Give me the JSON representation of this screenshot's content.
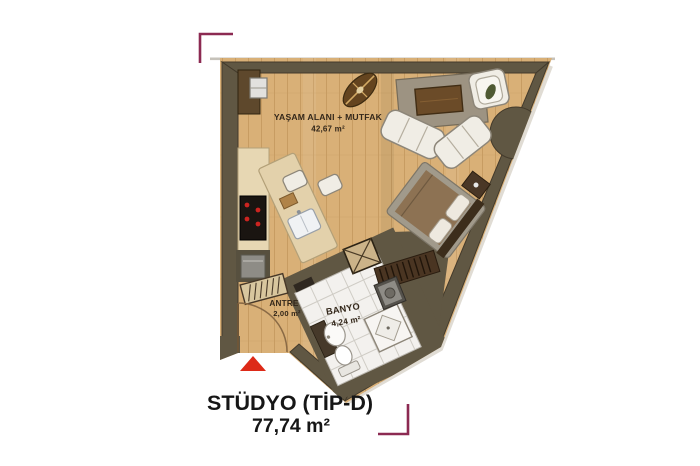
{
  "plan": {
    "title": "STÜDYO (TİP-D)",
    "total_area": "77,74 m²",
    "rooms": {
      "living": {
        "name": "YAŞAM ALANI + MUTFAK",
        "area": "42,67 m²"
      },
      "entry": {
        "name": "ANTRE",
        "area": "2,00 m²"
      },
      "bath": {
        "name": "BANYO",
        "area": "4,24 m²"
      }
    }
  },
  "colors": {
    "wall": "#605743",
    "wall_edge": "#433a2b",
    "floor": "#d9b077",
    "floor_line": "#c5995e",
    "tile": "#f3f1ee",
    "tile_line": "#cfccc5",
    "counter": "#e7d7b3",
    "counter_edge": "#b3a078",
    "island": "#e3d1ab",
    "rug": "#9d9382",
    "rug_edge": "#756b59",
    "wood_dark": "#5e482c",
    "white_furniture": "#f0ede5",
    "furniture_edge": "#8d8679",
    "bed_blanket": "#a19a8b",
    "bed_spread": "#8d7253",
    "headboard": "#3c2d1b",
    "appliance_gray": "#8e8c86",
    "cooktop_black": "#1a1511",
    "burner_red": "#cc2420",
    "marker": "#8c2a52",
    "entrance_arrow": "#dd2a18",
    "label_text": "#33271a",
    "title_text": "#161616",
    "outline_gray": "#c6c2ba"
  },
  "furniture": [
    "ceiling-fan",
    "area-rug",
    "coffee-table",
    "sofa",
    "armchair",
    "plant-leaf",
    "bed",
    "nightstand",
    "radiator-bench",
    "utility-shaft",
    "washing-machine",
    "shower",
    "washbasin",
    "toilet",
    "kitchen-island",
    "island-sink",
    "cutting-board",
    "bar-stool",
    "cooktop",
    "oven",
    "refrigerator",
    "kitchen-appliance",
    "shoe-bench",
    "entrance-door",
    "round-column"
  ]
}
